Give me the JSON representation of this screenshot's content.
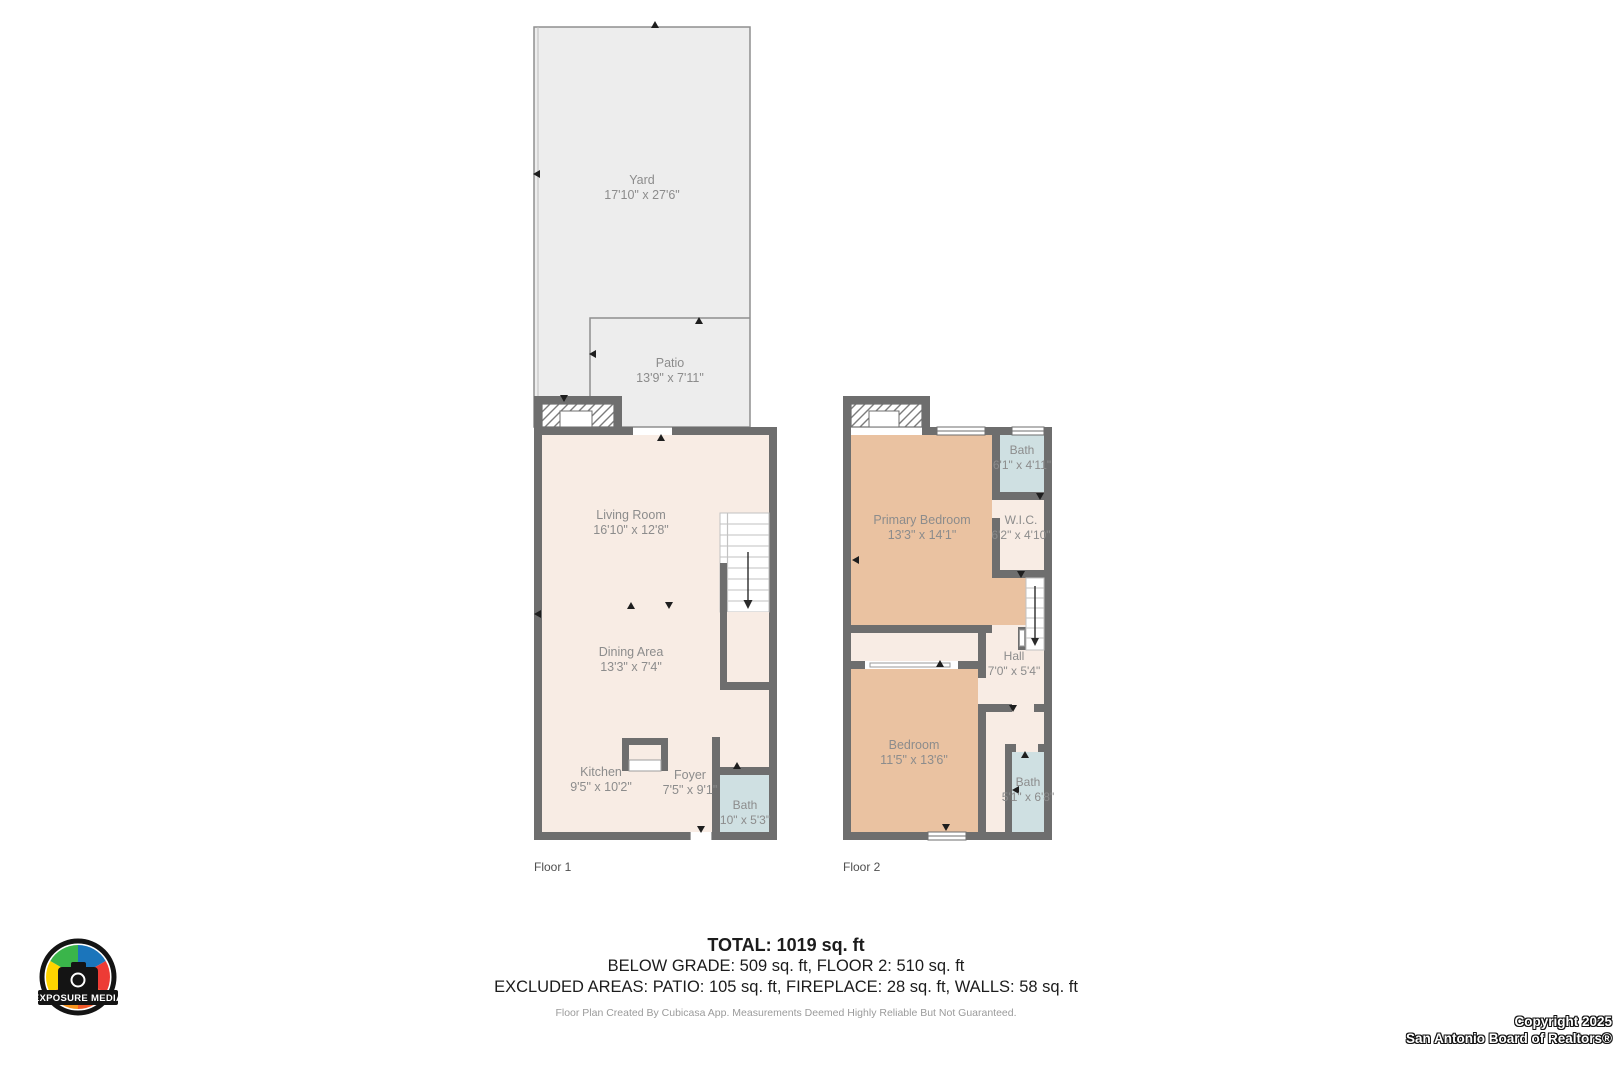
{
  "floor1": {
    "caption": "Floor 1",
    "rooms": [
      {
        "name": "Yard",
        "dim": "17'10\" x 27'6\""
      },
      {
        "name": "Patio",
        "dim": "13'9\" x 7'11\""
      },
      {
        "name": "Living Room",
        "dim": "16'10\" x 12'8\""
      },
      {
        "name": "Dining Area",
        "dim": "13'3\" x 7'4\""
      },
      {
        "name": "Kitchen",
        "dim": "9'5\" x 10'2\""
      },
      {
        "name": "Foyer",
        "dim": "7'5\" x 9'1\""
      },
      {
        "name": "Bath",
        "dim": "10\" x 5'3\""
      }
    ]
  },
  "floor2": {
    "caption": "Floor 2",
    "rooms": [
      {
        "name": "Primary Bedroom",
        "dim": "13'3\" x 14'1\""
      },
      {
        "name": "Bath",
        "dim": "6'1\" x 4'11\""
      },
      {
        "name": "W.I.C.",
        "dim": "6'2\" x 4'10\""
      },
      {
        "name": "Hall",
        "dim": "7'0\" x 5'4\""
      },
      {
        "name": "Bedroom",
        "dim": "11'5\" x 13'6\""
      },
      {
        "name": "Bath",
        "dim": "5'1\" x 6'8\""
      }
    ]
  },
  "summary": {
    "total": "TOTAL: 1019 sq. ft",
    "line2": "BELOW GRADE: 509 sq. ft, FLOOR 2: 510 sq. ft",
    "line3": "EXCLUDED AREAS: PATIO: 105 sq. ft, FIREPLACE: 28 sq. ft, WALLS: 58 sq. ft",
    "disclaimer": "Floor Plan Created By Cubicasa App. Measurements Deemed Highly Reliable But Not Guaranteed."
  },
  "branding": {
    "logo_text": "EXPOSURE MEDIA",
    "copyright_line1": "Copyright 2025",
    "copyright_line2": "San Antonio Board of Realtors®"
  },
  "colors": {
    "wall": "#6e6e6e",
    "floor_cream": "#f8ece4",
    "bedroom_tan": "#eac2a1",
    "bath_blue": "#cfe0e2",
    "yard_gray": "#ededed",
    "label_gray": "#8c8c8c"
  }
}
